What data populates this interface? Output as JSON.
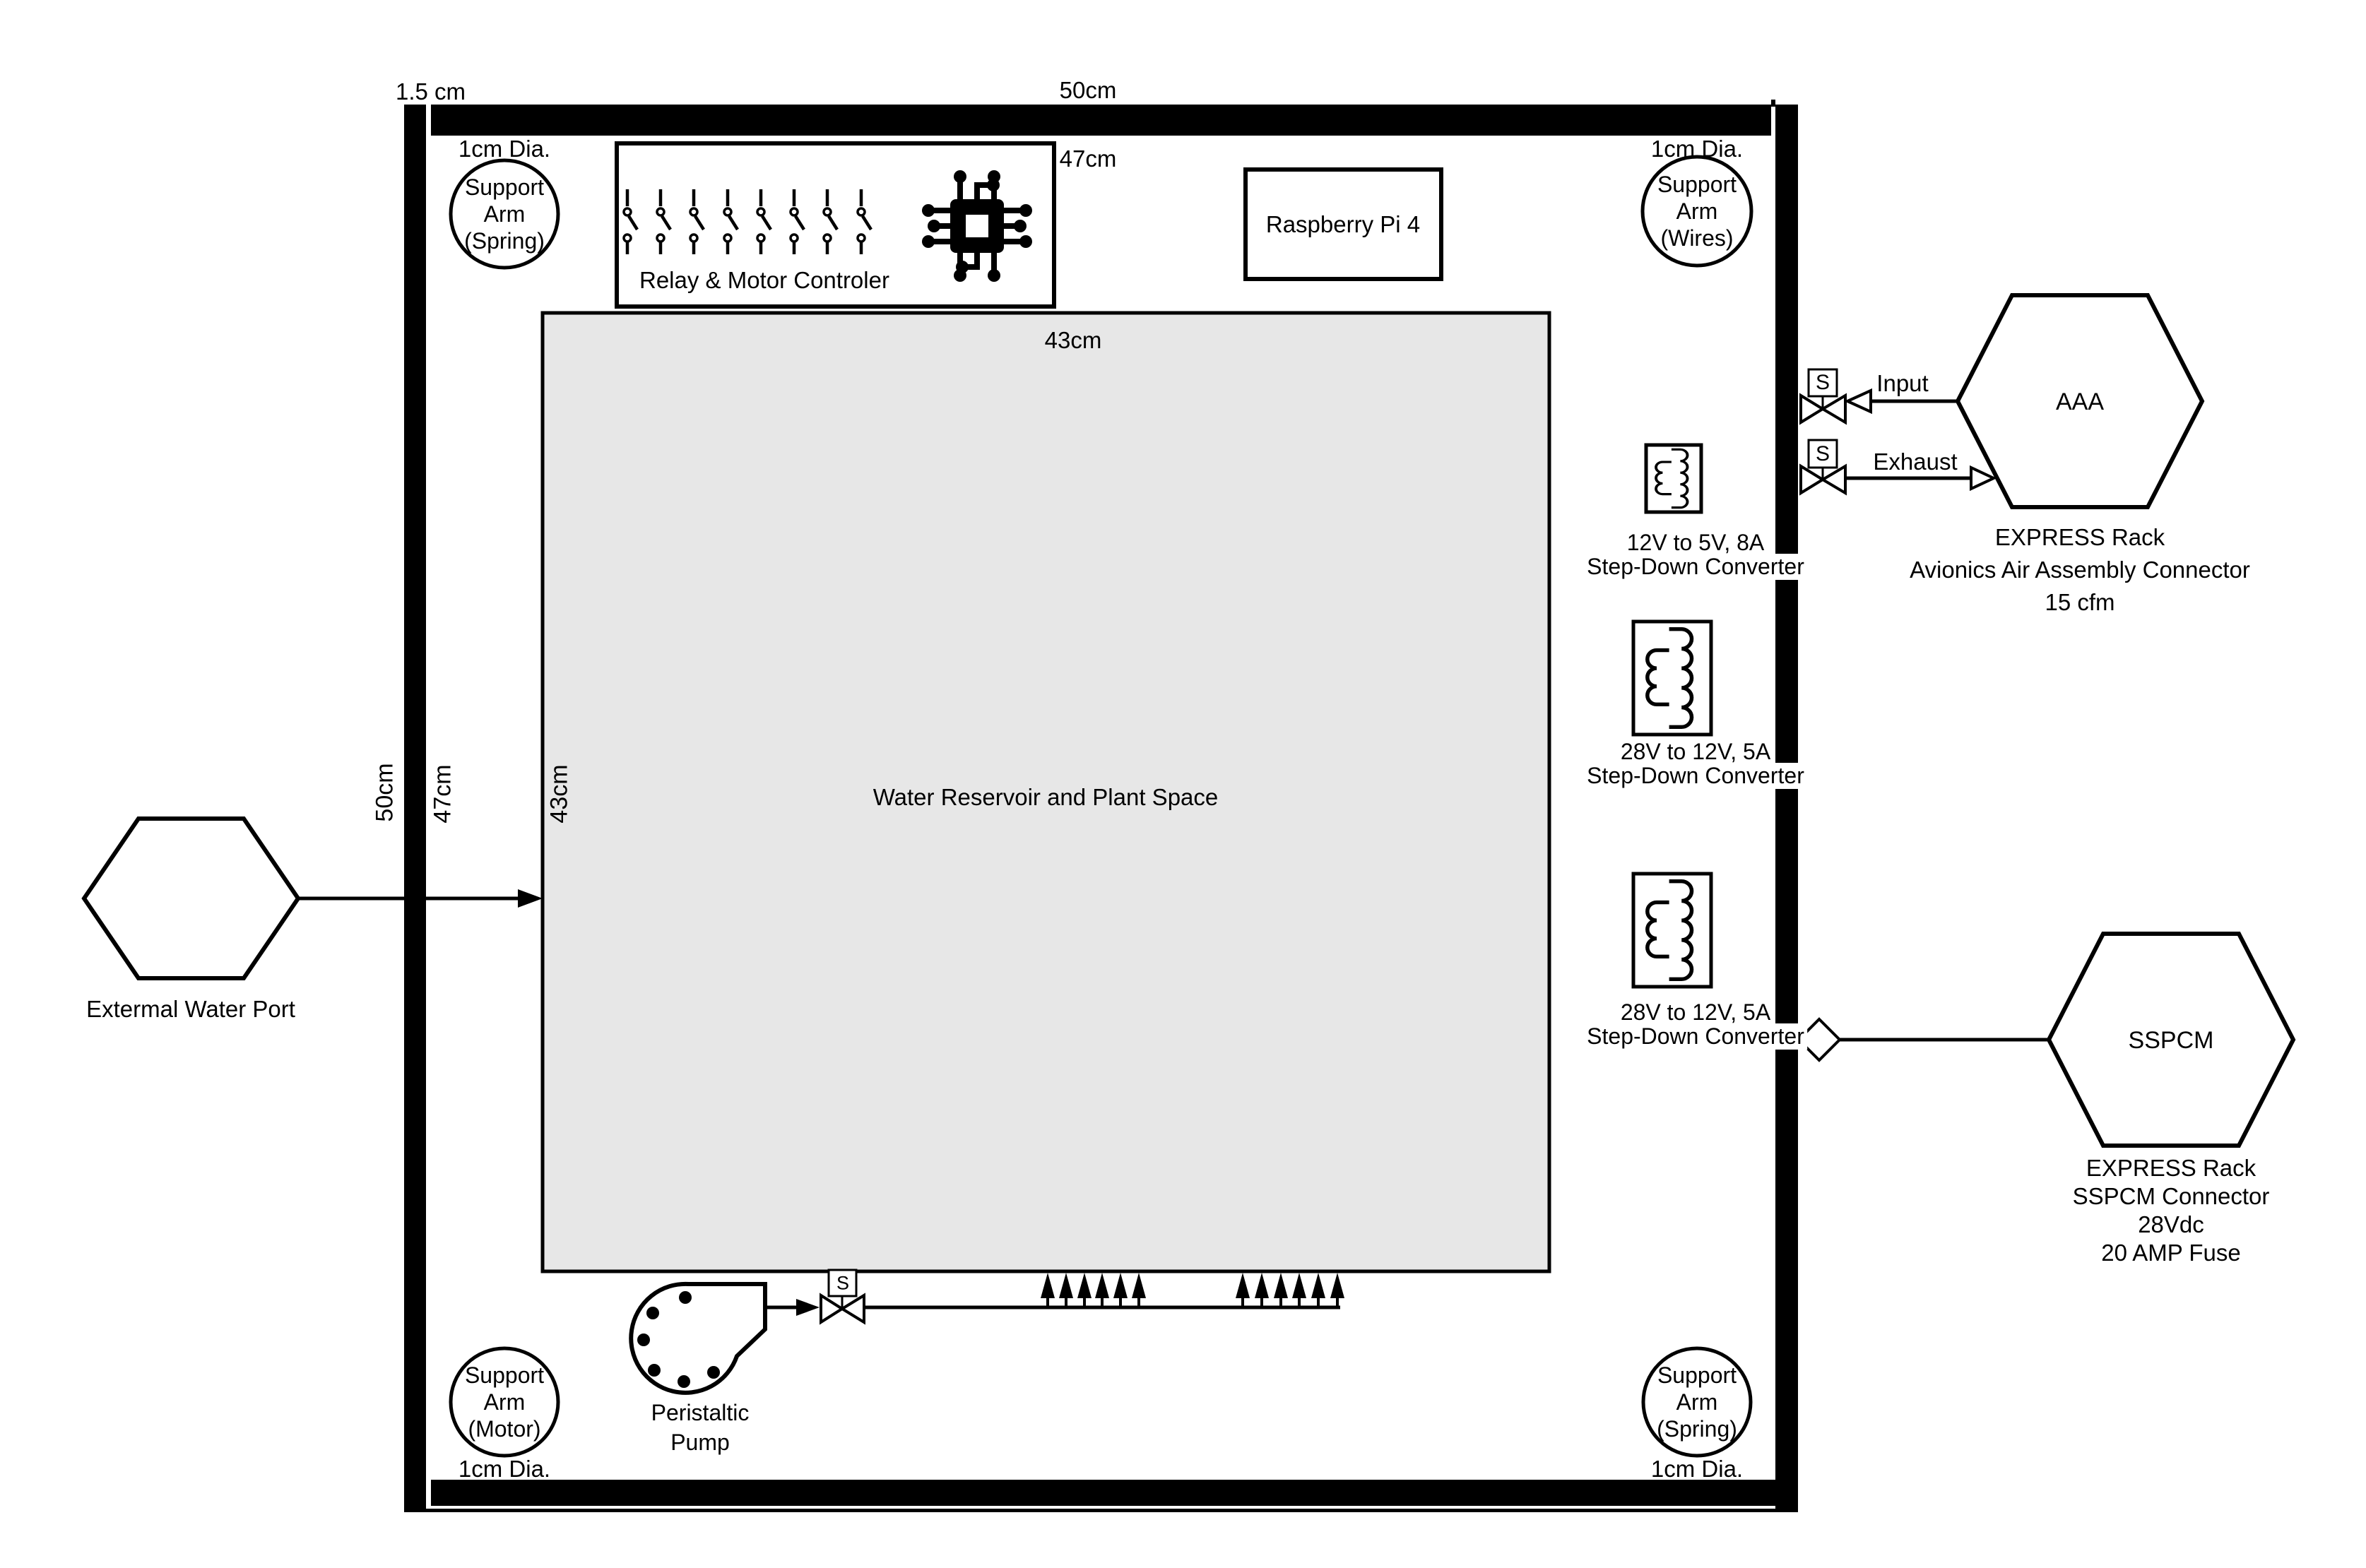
{
  "colors": {
    "line": "#000000",
    "reservoir_fill": "#e7e7e7",
    "background": "#ffffff"
  },
  "frame": {
    "thickness_label": "1.5 cm",
    "outer_width_label": "50cm",
    "inner_width_label": "47cm",
    "outer_height_label": "50cm",
    "inner_height_label": "47cm"
  },
  "reservoir": {
    "label": "Water Reservoir and Plant Space",
    "width_label": "43cm",
    "height_label": "43cm"
  },
  "support_arms": {
    "top_left": {
      "lines": [
        "Support",
        "Arm",
        "(Spring)"
      ],
      "diameter_label": "1cm Dia."
    },
    "top_right": {
      "lines": [
        "Support",
        "Arm",
        "(Wires)"
      ],
      "diameter_label": "1cm Dia."
    },
    "bottom_left": {
      "lines": [
        "Support",
        "Arm",
        "(Motor)"
      ],
      "diameter_label": "1cm Dia."
    },
    "bottom_right": {
      "lines": [
        "Support",
        "Arm",
        "(Spring)"
      ],
      "diameter_label": "1cm Dia."
    }
  },
  "relay_controller": {
    "label": "Relay & Motor Controler"
  },
  "raspberry_pi": {
    "label": "Raspberry Pi 4"
  },
  "external_water_port": {
    "label": "Extermal Water Port"
  },
  "peristaltic_pump": {
    "lines": [
      "Peristaltic",
      "Pump"
    ]
  },
  "solenoid_valve_letter": "S",
  "converters": [
    {
      "spec": "12V to 5V, 8A",
      "type": "Step-Down Converter"
    },
    {
      "spec": "28V to 12V, 5A",
      "type": "Step-Down Converter"
    },
    {
      "spec": "28V to 12V, 5A",
      "type": "Step-Down Converter"
    }
  ],
  "aaa": {
    "label": "AAA",
    "input_label": "Input",
    "exhaust_label": "Exhaust",
    "caption": [
      "EXPRESS Rack",
      "Avionics Air Assembly Connector",
      "15 cfm"
    ]
  },
  "sspcm": {
    "label": "SSPCM",
    "caption": [
      "EXPRESS Rack",
      "SSPCM Connector",
      "28Vdc",
      "20 AMP Fuse"
    ]
  }
}
